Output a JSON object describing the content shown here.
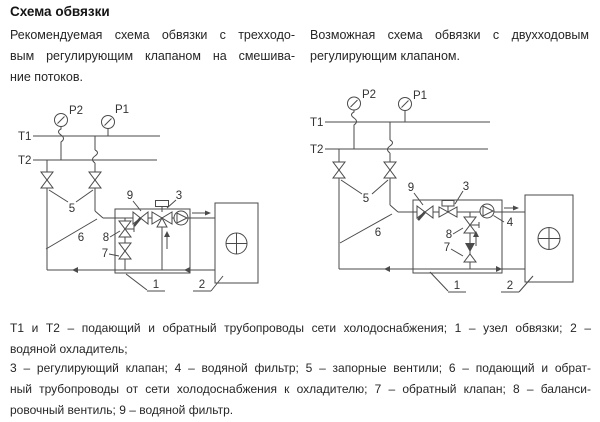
{
  "title": "Схема обвязки",
  "captions": {
    "left": {
      "line1": "Рекомендуемая схема обвязки с трехходо-",
      "line2": "вым регулирующим клапаном на смешива-",
      "line3": "ние потоков."
    },
    "right": {
      "line1": "Возможная схема обвязки с двухходовым",
      "line2": "регулирующим клапаном."
    }
  },
  "legend": {
    "block1": {
      "line1": "Т1 и Т2 – подающий и обратный трубопроводы сети холодоснабжения; 1 – узел обвязки; 2 –",
      "line2": "водяной охладитель;"
    },
    "block2": {
      "line1": "3 – регулирующий клапан; 4 – водяной фильтр; 5 – запорные вентили; 6 – подающий и обрат-",
      "line2": "ный трубопроводы от сети холодоснабжения к охладителю; 7 – обратный клапан; 8 – баланси-",
      "line3": "ровочный вентиль; 9 – водяной фильтр."
    }
  },
  "labels_left": {
    "t1": "Т1",
    "t2": "Т2",
    "p1": "P1",
    "p2": "P2",
    "n1": "1",
    "n2": "2",
    "n3": "3",
    "n5": "5",
    "n6": "6",
    "n7": "7",
    "n8": "8",
    "n9": "9"
  },
  "labels_right": {
    "t1": "Т1",
    "t2": "Т2",
    "p1": "P1",
    "p2": "P2",
    "n1": "1",
    "n2": "2",
    "n3": "3",
    "n4": "4",
    "n5": "5",
    "n6": "6",
    "n7": "7",
    "n8": "8",
    "n9": "9"
  },
  "colors": {
    "line": "#4a4a4a",
    "text": "#262626",
    "background": "#ffffff"
  }
}
